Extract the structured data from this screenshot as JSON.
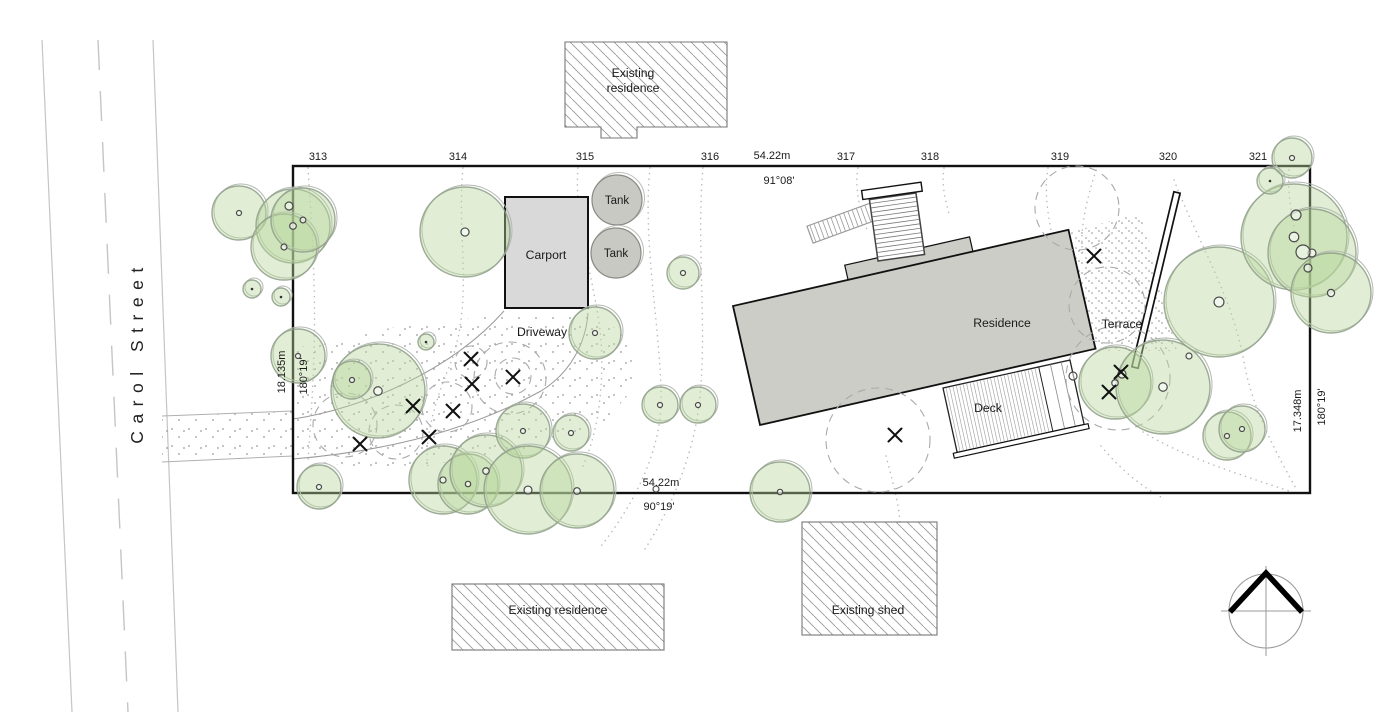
{
  "meta": {
    "title": "Site plan",
    "canvas_width": 1400,
    "canvas_height": 712
  },
  "street": {
    "name": "Carol Street"
  },
  "labels": {
    "existing_residence_top_line1": "Existing",
    "existing_residence_top_line2": "residence",
    "existing_residence_bottom": "Existing residence",
    "existing_shed": "Existing shed",
    "carport": "Carport",
    "tank_upper": "Tank",
    "tank_lower": "Tank",
    "driveway": "Driveway",
    "residence": "Residence",
    "deck": "Deck",
    "terrace": "Terrace"
  },
  "boundary": {
    "top_length": "54.22m",
    "top_bearing": "91°08'",
    "bottom_length": "54.22m",
    "bottom_bearing": "90°19'",
    "left_length": "18.135m",
    "left_bearing": "180°19'",
    "right_length": "17.348m",
    "right_bearing": "180°19'",
    "survey_marks": [
      {
        "label": "313",
        "x": 318
      },
      {
        "label": "314",
        "x": 458
      },
      {
        "label": "315",
        "x": 585
      },
      {
        "label": "316",
        "x": 710
      },
      {
        "label": "317",
        "x": 846
      },
      {
        "label": "318",
        "x": 930
      },
      {
        "label": "319",
        "x": 1060
      },
      {
        "label": "320",
        "x": 1168
      },
      {
        "label": "321",
        "x": 1258
      }
    ],
    "survey_marks_y": 160
  },
  "colors": {
    "boundary": "#111111",
    "building_fill": "#cdcdc7",
    "carport_fill": "#d9d9d9",
    "tank_fill": "#c9c9c3",
    "tree_fill": "#b8d79c",
    "tree_stroke": "#8e9e88",
    "contour": "#b8b8b8",
    "hatch": "#999999",
    "road": "#c4c4ca",
    "canopy_dashed": "#a9a9a9"
  },
  "trees": [
    {
      "x": 239,
      "y": 213,
      "r": 27
    },
    {
      "x": 293,
      "y": 226,
      "r": 37
    },
    {
      "x": 284,
      "y": 247,
      "r": 33
    },
    {
      "x": 303,
      "y": 220,
      "r": 32
    },
    {
      "x": 252,
      "y": 289,
      "r": 9
    },
    {
      "x": 281,
      "y": 297,
      "r": 9
    },
    {
      "x": 465,
      "y": 232,
      "r": 45
    },
    {
      "x": 378,
      "y": 391,
      "r": 47
    },
    {
      "x": 352,
      "y": 380,
      "r": 19
    },
    {
      "x": 298,
      "y": 356,
      "r": 27
    },
    {
      "x": 426,
      "y": 342,
      "r": 8
    },
    {
      "x": 319,
      "y": 487,
      "r": 22
    },
    {
      "x": 443,
      "y": 480,
      "r": 34
    },
    {
      "x": 468,
      "y": 484,
      "r": 30
    },
    {
      "x": 486,
      "y": 471,
      "r": 36
    },
    {
      "x": 523,
      "y": 431,
      "r": 27
    },
    {
      "x": 571,
      "y": 433,
      "r": 18
    },
    {
      "x": 528,
      "y": 490,
      "r": 44
    },
    {
      "x": 577,
      "y": 491,
      "r": 37
    },
    {
      "x": 595,
      "y": 333,
      "r": 26
    },
    {
      "x": 683,
      "y": 273,
      "r": 16
    },
    {
      "x": 660,
      "y": 405,
      "r": 18
    },
    {
      "x": 698,
      "y": 405,
      "r": 18
    },
    {
      "x": 780,
      "y": 492,
      "r": 30
    },
    {
      "x": 1115,
      "y": 383,
      "r": 36
    },
    {
      "x": 1163,
      "y": 387,
      "r": 47
    },
    {
      "x": 1227,
      "y": 436,
      "r": 24
    },
    {
      "x": 1242,
      "y": 429,
      "r": 23
    },
    {
      "x": 1219,
      "y": 302,
      "r": 55
    },
    {
      "x": 1294,
      "y": 237,
      "r": 53
    },
    {
      "x": 1312,
      "y": 253,
      "r": 44
    },
    {
      "x": 1331,
      "y": 293,
      "r": 40
    },
    {
      "x": 1292,
      "y": 158,
      "r": 20
    },
    {
      "x": 1270,
      "y": 181,
      "r": 13
    }
  ],
  "extra_trunks": [
    {
      "x": 289,
      "y": 206,
      "r": 4
    },
    {
      "x": 1303,
      "y": 252,
      "r": 7
    },
    {
      "x": 1296,
      "y": 215,
      "r": 5
    },
    {
      "x": 1308,
      "y": 268,
      "r": 4
    },
    {
      "x": 1122,
      "y": 374,
      "r": 4
    },
    {
      "x": 1189,
      "y": 356,
      "r": 3
    },
    {
      "x": 656,
      "y": 489,
      "r": 3
    },
    {
      "x": 1073,
      "y": 376,
      "r": 4
    }
  ],
  "removed_tree_marks": [
    {
      "x": 471,
      "y": 359
    },
    {
      "x": 472,
      "y": 384
    },
    {
      "x": 513,
      "y": 377
    },
    {
      "x": 413,
      "y": 406
    },
    {
      "x": 453,
      "y": 411
    },
    {
      "x": 429,
      "y": 437
    },
    {
      "x": 360,
      "y": 444
    },
    {
      "x": 895,
      "y": 435
    },
    {
      "x": 1094,
      "y": 256
    },
    {
      "x": 1121,
      "y": 372
    },
    {
      "x": 1109,
      "y": 392
    }
  ],
  "dashed_canopies": [
    {
      "x": 878,
      "y": 440,
      "r": 52
    },
    {
      "x": 1077,
      "y": 208,
      "r": 42
    },
    {
      "x": 1107,
      "y": 305,
      "r": 38
    },
    {
      "x": 1118,
      "y": 378,
      "r": 52
    },
    {
      "x": 510,
      "y": 378,
      "r": 36
    },
    {
      "x": 447,
      "y": 407,
      "r": 25
    },
    {
      "x": 396,
      "y": 432,
      "r": 27
    },
    {
      "x": 345,
      "y": 425,
      "r": 32
    },
    {
      "x": 513,
      "y": 376,
      "r": 18
    },
    {
      "x": 471,
      "y": 362,
      "r": 16
    }
  ],
  "contours": [
    "M463,168 C456,240 476,305 447,372 C433,408 424,442 428,468",
    "M578,168 C574,215 590,265 599,322 C606,372 600,430 582,468",
    "M650,168 C642,245 662,335 661,404 C660,450 636,502 601,546",
    "M703,168 C696,245 708,335 699,404 C694,452 672,508 643,552",
    "M858,168 C854,190 861,212 867,230",
    "M944,168 C941,186 946,202 949,214",
    "M1048,168 C1044,192 1048,214 1051,230",
    "M1174,180 C1198,242 1232,295 1244,362 C1252,408 1277,455 1297,490",
    "M1096,170 C1086,202 1079,232 1083,256",
    "M886,456 C896,494 905,524 898,558",
    "M1143,432 C1182,456 1232,472 1289,491",
    "M1101,446 C1121,470 1141,486 1161,497",
    "M1289,170 C1287,195 1293,220 1297,245",
    "M308,168 C312,230 316,290 314,350 C313,395 310,430 308,462"
  ],
  "driveway_edges": [
    "M293,419 C360,409 450,372 504,311",
    "M293,459 C390,451 472,429 541,391 C572,372 586,341 588,313"
  ]
}
